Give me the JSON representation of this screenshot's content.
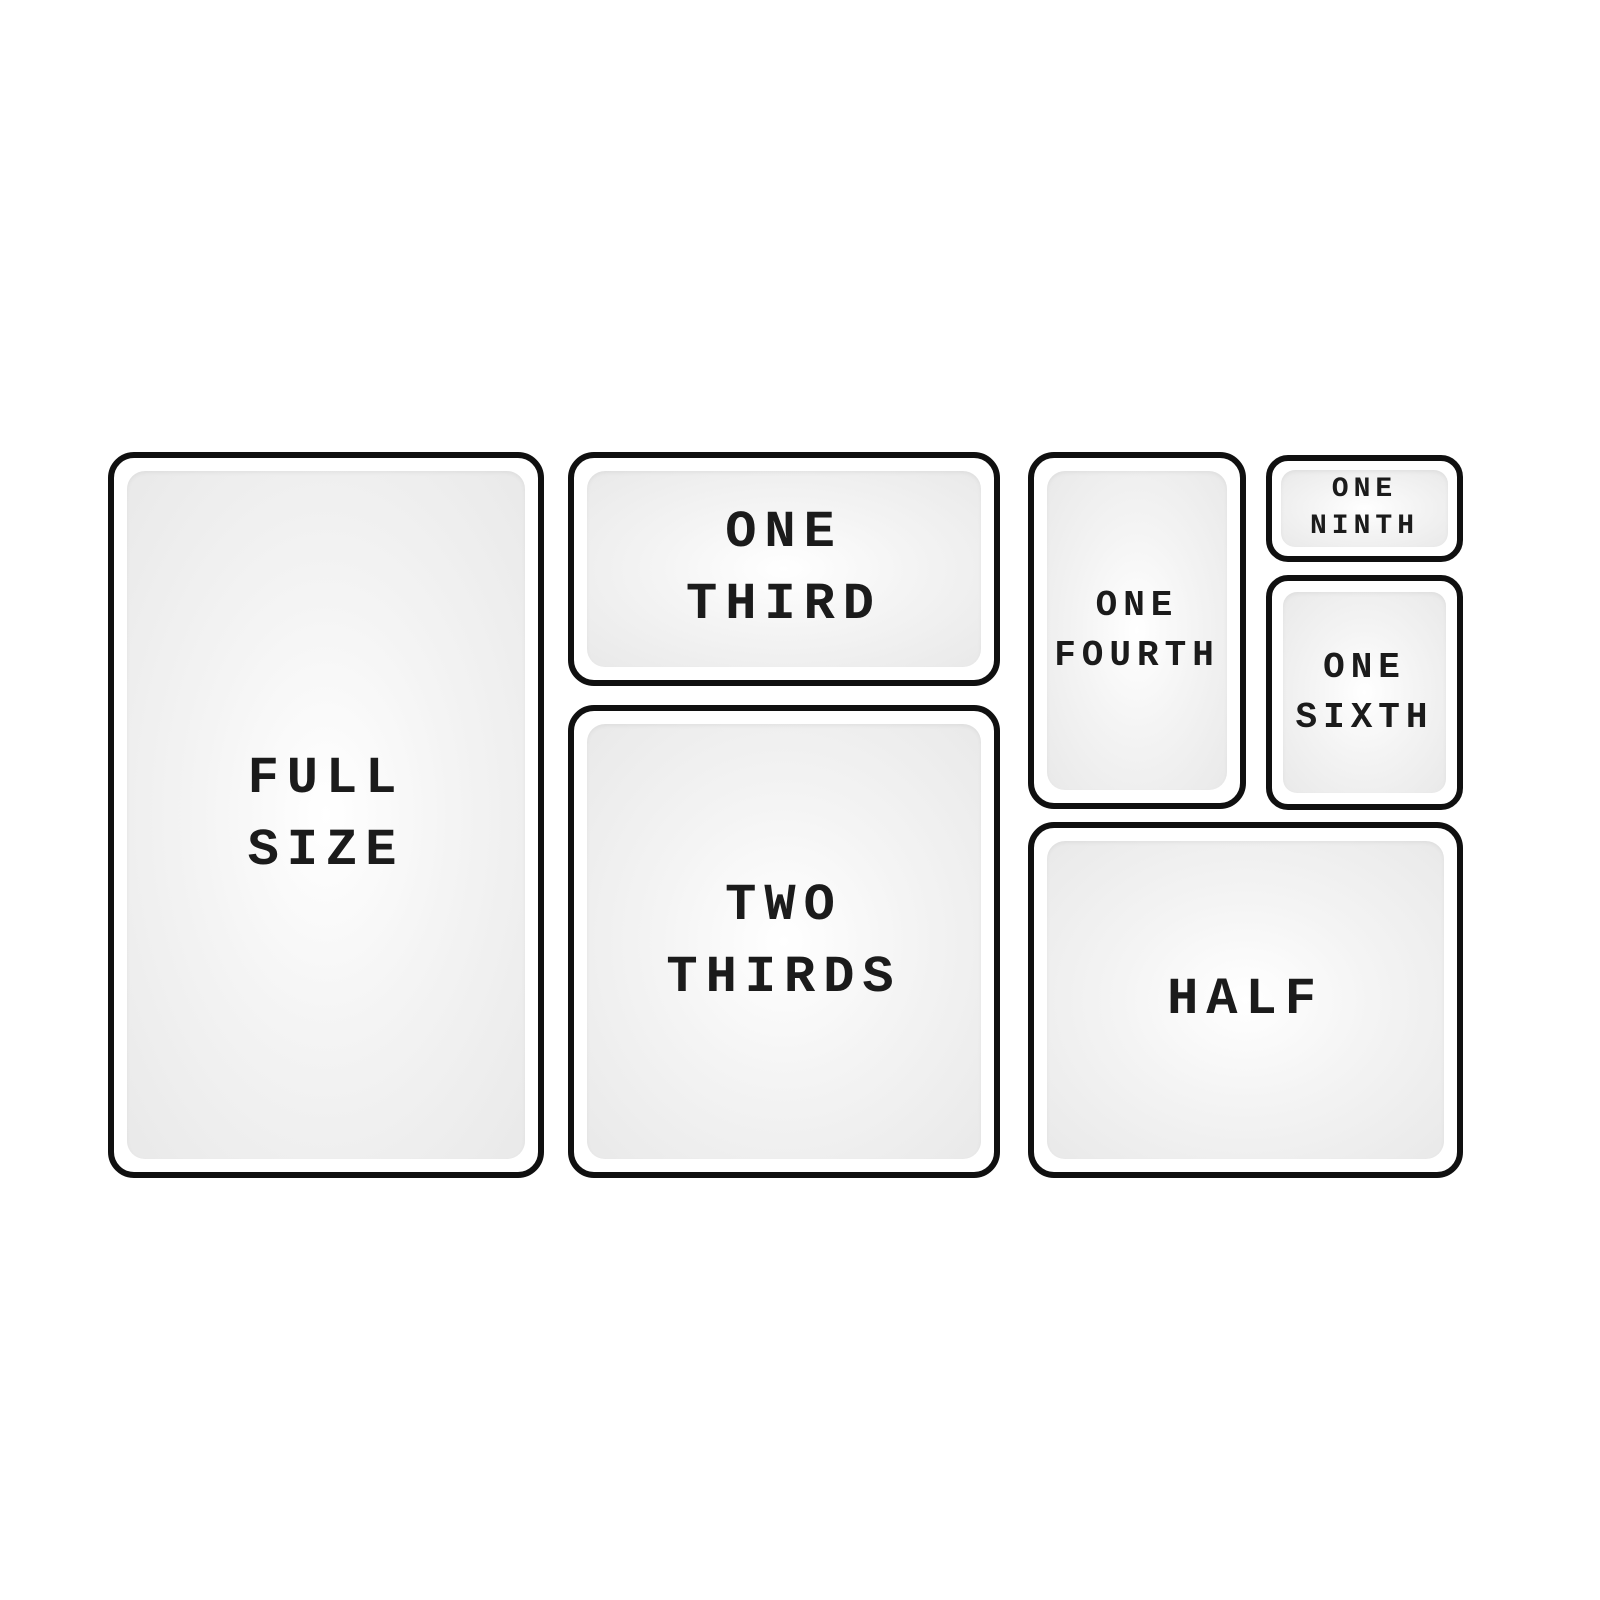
{
  "diagram": {
    "colors": {
      "background": "#ffffff",
      "pan_border": "#101010",
      "pan_fill_center": "#ffffff",
      "pan_fill_edge": "#e9e9e9",
      "label_text": "#1b1b1b"
    },
    "pans": {
      "full_size": {
        "line1": "FULL",
        "line2": "SIZE"
      },
      "one_third": {
        "line1": "ONE",
        "line2": "THIRD"
      },
      "two_thirds": {
        "line1": "TWO",
        "line2": "THIRDS"
      },
      "one_fourth": {
        "line1": "ONE",
        "line2": "FOURTH"
      },
      "one_ninth": {
        "line1": "ONE",
        "line2": "NINTH"
      },
      "one_sixth": {
        "line1": "ONE",
        "line2": "SIXTH"
      },
      "half": {
        "line1": "HALF"
      }
    }
  }
}
